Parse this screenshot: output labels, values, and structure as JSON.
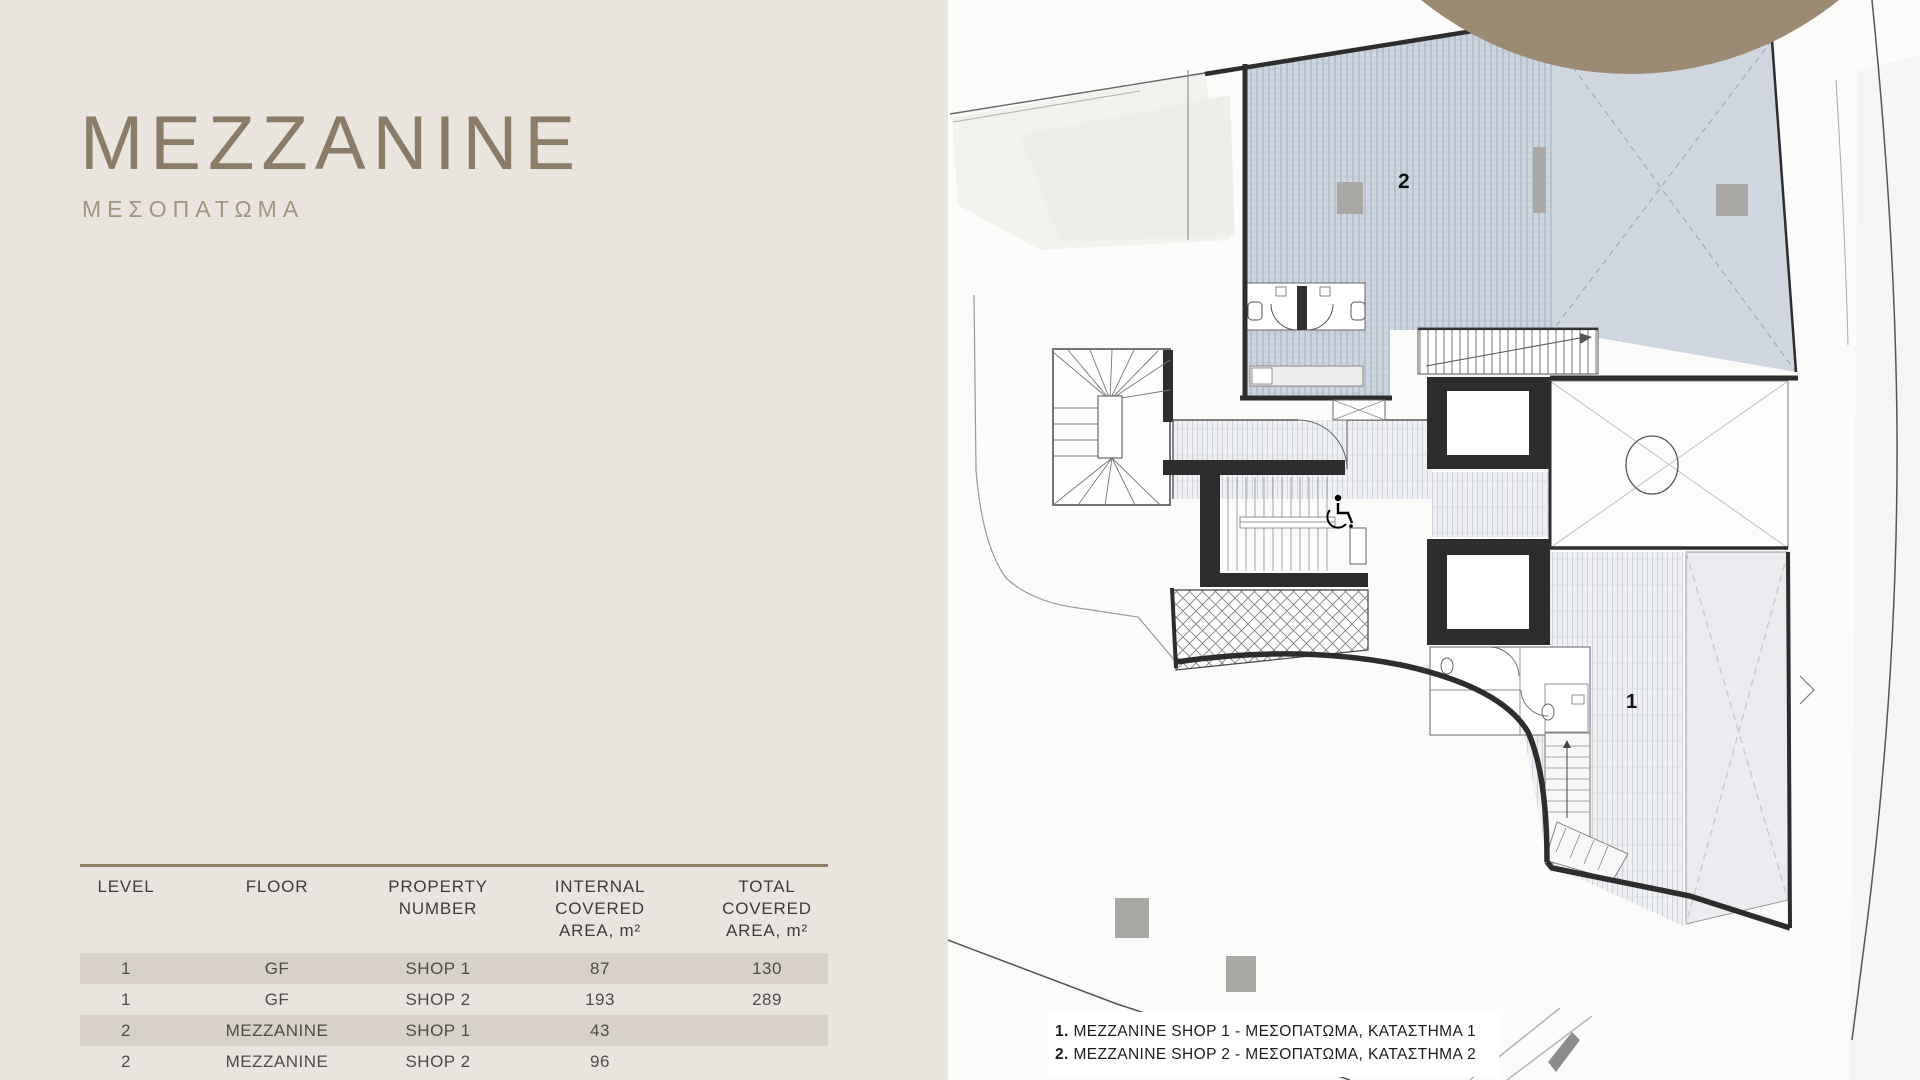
{
  "page": {
    "title": "MEZZANINE",
    "subtitle": "ΜΕΣΟΠΑΤΩΜΑ"
  },
  "colors": {
    "panel_background": "#e9e5de",
    "accent_brown_circle": "#9c8b72",
    "title_brown": "#8a7c67",
    "table_border_brown": "#8d7c60",
    "row_shade": "#d7d1c7",
    "plan_blue_hatch": "#cdd5df",
    "wall_dark": "#2d2d2d"
  },
  "table": {
    "columns": [
      [
        "LEVEL"
      ],
      [
        "FLOOR"
      ],
      [
        "PROPERTY",
        "NUMBER"
      ],
      [
        "INTERNAL",
        "COVERED",
        "AREA, m²"
      ],
      [
        "TOTAL",
        "COVERED",
        "AREA, m²"
      ]
    ],
    "rows": [
      [
        "1",
        "GF",
        "SHOP 1",
        "87",
        "130"
      ],
      [
        "1",
        "GF",
        "SHOP 2",
        "193",
        "289"
      ],
      [
        "2",
        "MEZZANINE",
        "SHOP 1",
        "43",
        ""
      ],
      [
        "2",
        "MEZZANINE",
        "SHOP 2",
        "96",
        ""
      ]
    ]
  },
  "plan": {
    "labels": {
      "shop1": "1",
      "shop2": "2"
    },
    "legend": [
      {
        "num": "1.",
        "text": " MEZZANINE SHOP 1 - ΜΕΣΟΠΑΤΩΜΑ, ΚΑΤΑΣΤΗΜΑ 1"
      },
      {
        "num": "2.",
        "text": " MEZZANINE SHOP 2 - ΜΕΣΟΠΑΤΩΜΑ, ΚΑΤΑΣΤΗΜΑ 2"
      }
    ]
  }
}
